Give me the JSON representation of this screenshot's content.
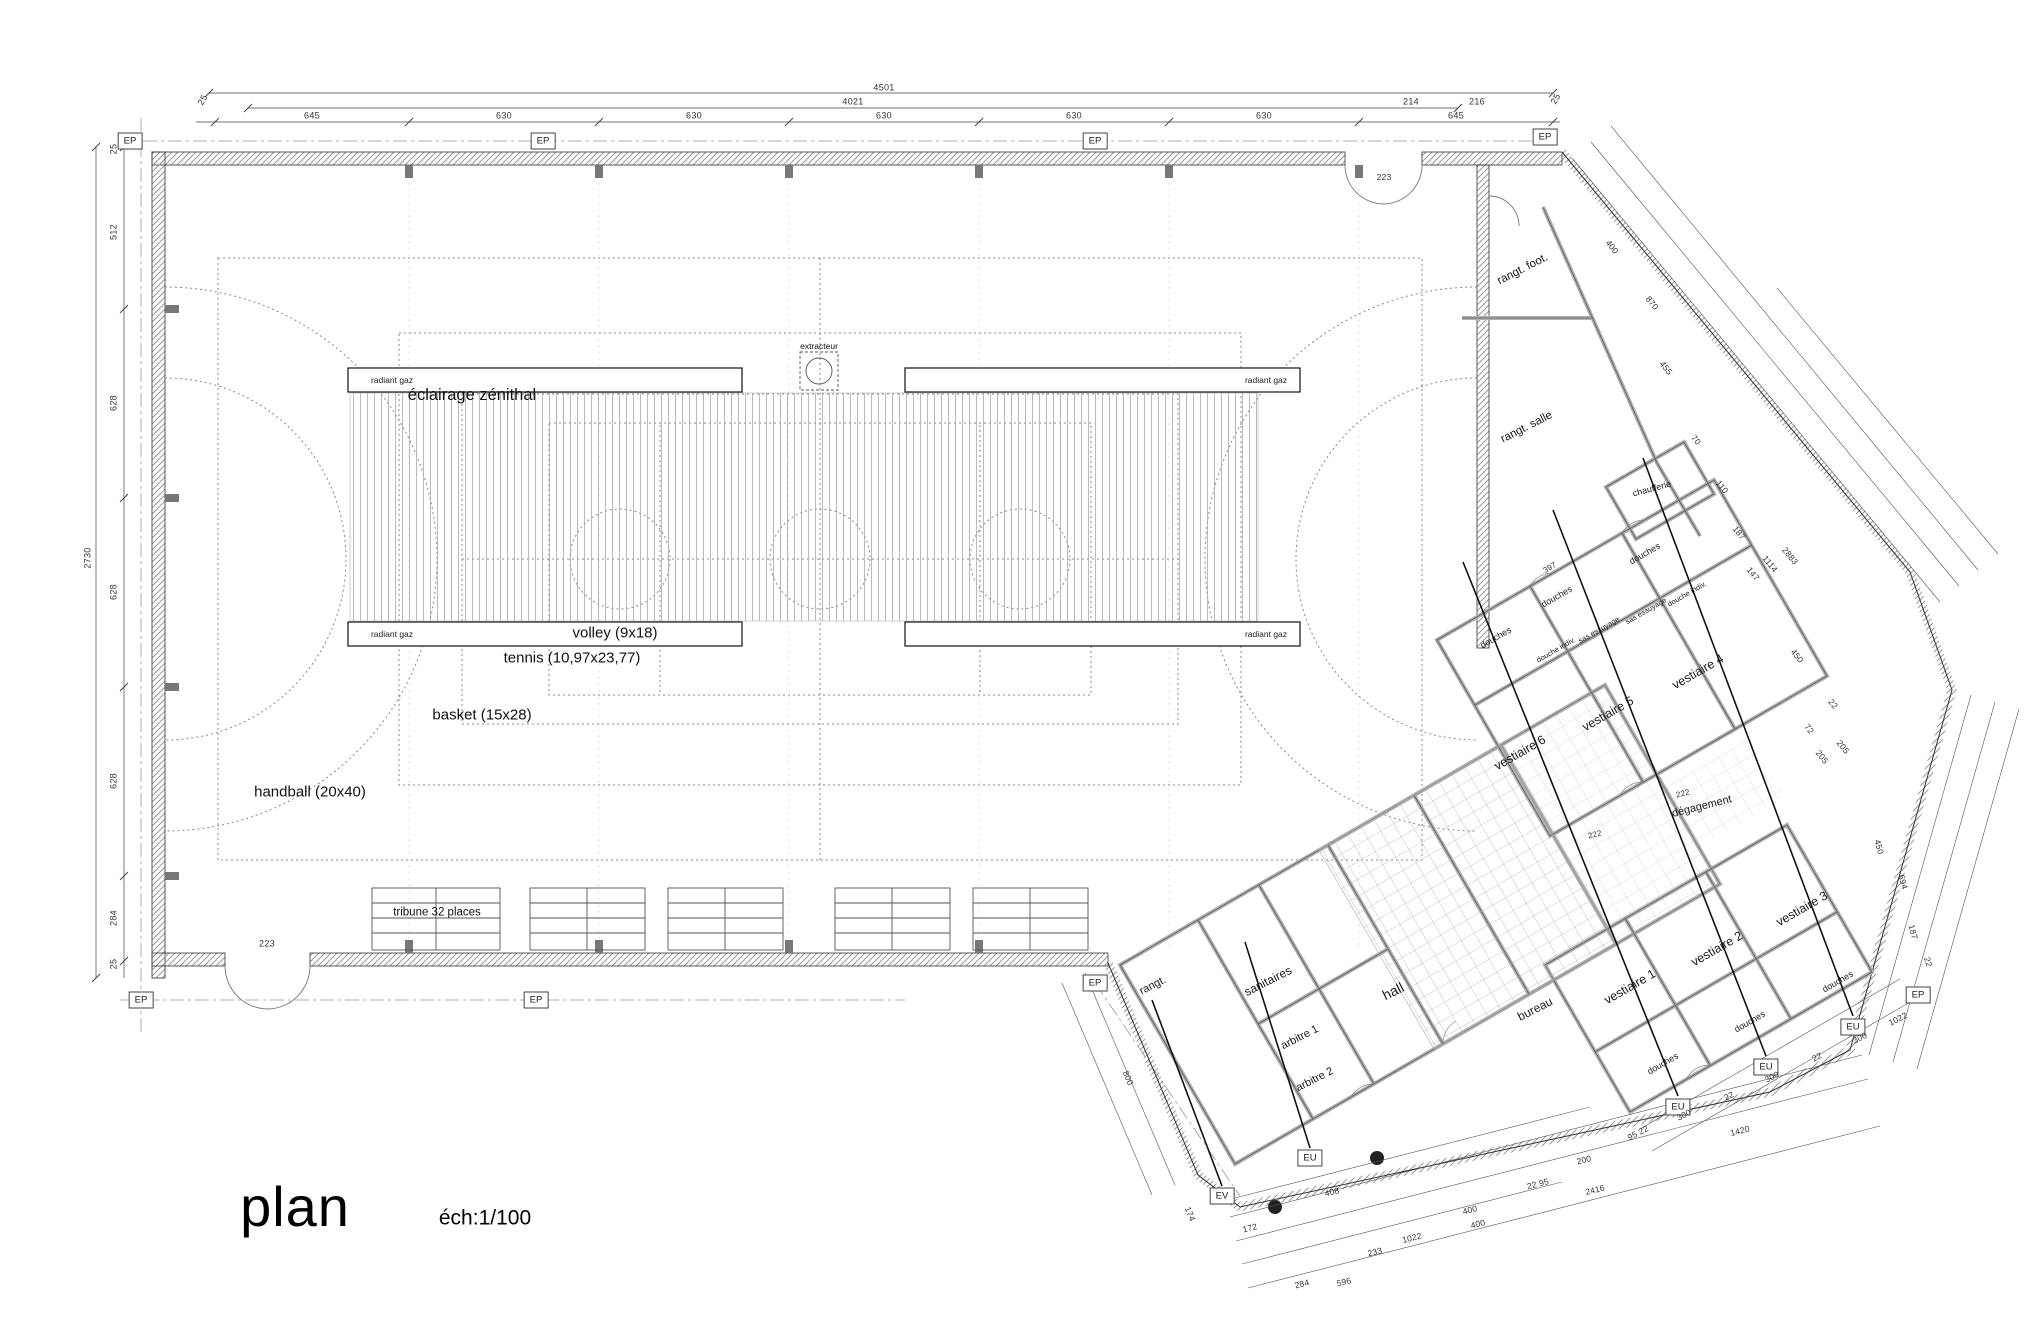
{
  "title": {
    "name": "plan",
    "scale": "éch:1/100"
  },
  "hall": {
    "skylight_label": "éclairage zénithal",
    "extractor_label": "extracteur",
    "radiant_label": "radiant gaz",
    "tribune_label": "tribune 32 places",
    "courts": [
      "volley (9x18)",
      "tennis (10,97x23,77)",
      "basket (15x28)",
      "handball (20x40)"
    ]
  },
  "markers": {
    "ep": "EP",
    "eu": "EU",
    "ev": "EV"
  },
  "dims": {
    "top": {
      "overall": "4501",
      "inner": "4021",
      "segs": [
        "645",
        "630",
        "630",
        "630",
        "630",
        "630",
        "645"
      ],
      "sub": [
        "214",
        "216"
      ],
      "end": "25",
      "door": "223"
    },
    "left": {
      "overall": "2730",
      "list": [
        "25",
        "512",
        "628",
        "628",
        "628",
        "284",
        "25"
      ],
      "door": "223"
    },
    "wing_right": [
      "400",
      "870",
      "455",
      "70",
      "110",
      "187",
      "147",
      "1114",
      "2883",
      "450",
      "72",
      "22",
      "205",
      "205"
    ],
    "wing_right_lower": [
      "450",
      "694",
      "187",
      "22"
    ],
    "wing_vest_bottom": [
      "1022",
      "300",
      "22",
      "300",
      "22",
      "300",
      "95 22",
      "1420"
    ],
    "wing_bottom": [
      "172",
      "408",
      "233",
      "1022",
      "284",
      "596",
      "400",
      "400",
      "22 95",
      "200",
      "2416"
    ],
    "wing_left": [
      "800",
      "174"
    ],
    "wing_inner": [
      "397",
      "222",
      "222"
    ]
  },
  "wing": {
    "rooms": {
      "rangt_foot": "rangt. foot.",
      "rangt_salle": "rangt. salle",
      "chaufferie": "chaufferie",
      "v6": "vestiaire 6",
      "v5": "vestiaire 5",
      "v4": "vestiaire 4",
      "v1": "vestiaire 1",
      "v2": "vestiaire 2",
      "v3": "vestiaire 3",
      "degagement": "dégagement",
      "hall": "hall",
      "bureau": "bureau",
      "sanitaires": "sanitaires",
      "arbitre1": "arbitre 1",
      "arbitre2": "arbitre 2",
      "rangt": "rangt.",
      "douches": "douches",
      "douche_indiv": "douche indiv.",
      "sas": "sas essuyage"
    }
  }
}
